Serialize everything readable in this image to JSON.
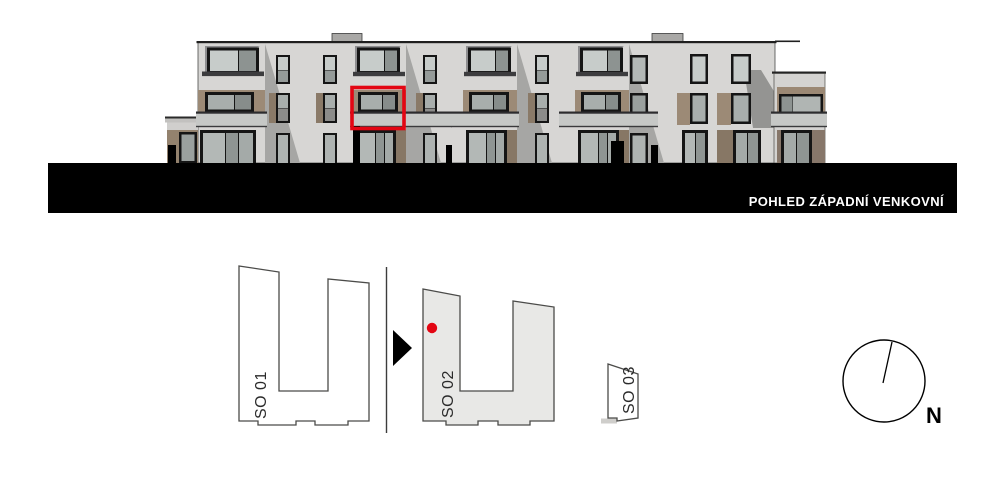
{
  "elevation": {
    "caption": "POHLED ZÁPADNÍ VENKOVNÍ",
    "highlighted_unit": {
      "floor": 2,
      "highlight_color": "#e30613"
    },
    "colors": {
      "wall": "#d7d6d4",
      "shadow": "#a6a6a4",
      "wood_upper": "#9c8a76",
      "wood_lower": "#877765",
      "glass_light": "#c7ccca",
      "glass_dark": "#8d9391",
      "railing": "#c6c8c6",
      "ground_band": "#000000"
    }
  },
  "site_plan": {
    "buildings": [
      {
        "id": "so-01",
        "label": "SO 01",
        "selected": false,
        "fill": "#ffffff"
      },
      {
        "id": "so-02",
        "label": "SO 02",
        "selected": true,
        "fill": "#e8e8e6",
        "unit_marker_color": "#e30613"
      },
      {
        "id": "so-03",
        "label": "SO 03",
        "selected": false,
        "fill": "#ffffff"
      }
    ],
    "arrow_direction": "right",
    "compass": {
      "label": "N"
    }
  }
}
